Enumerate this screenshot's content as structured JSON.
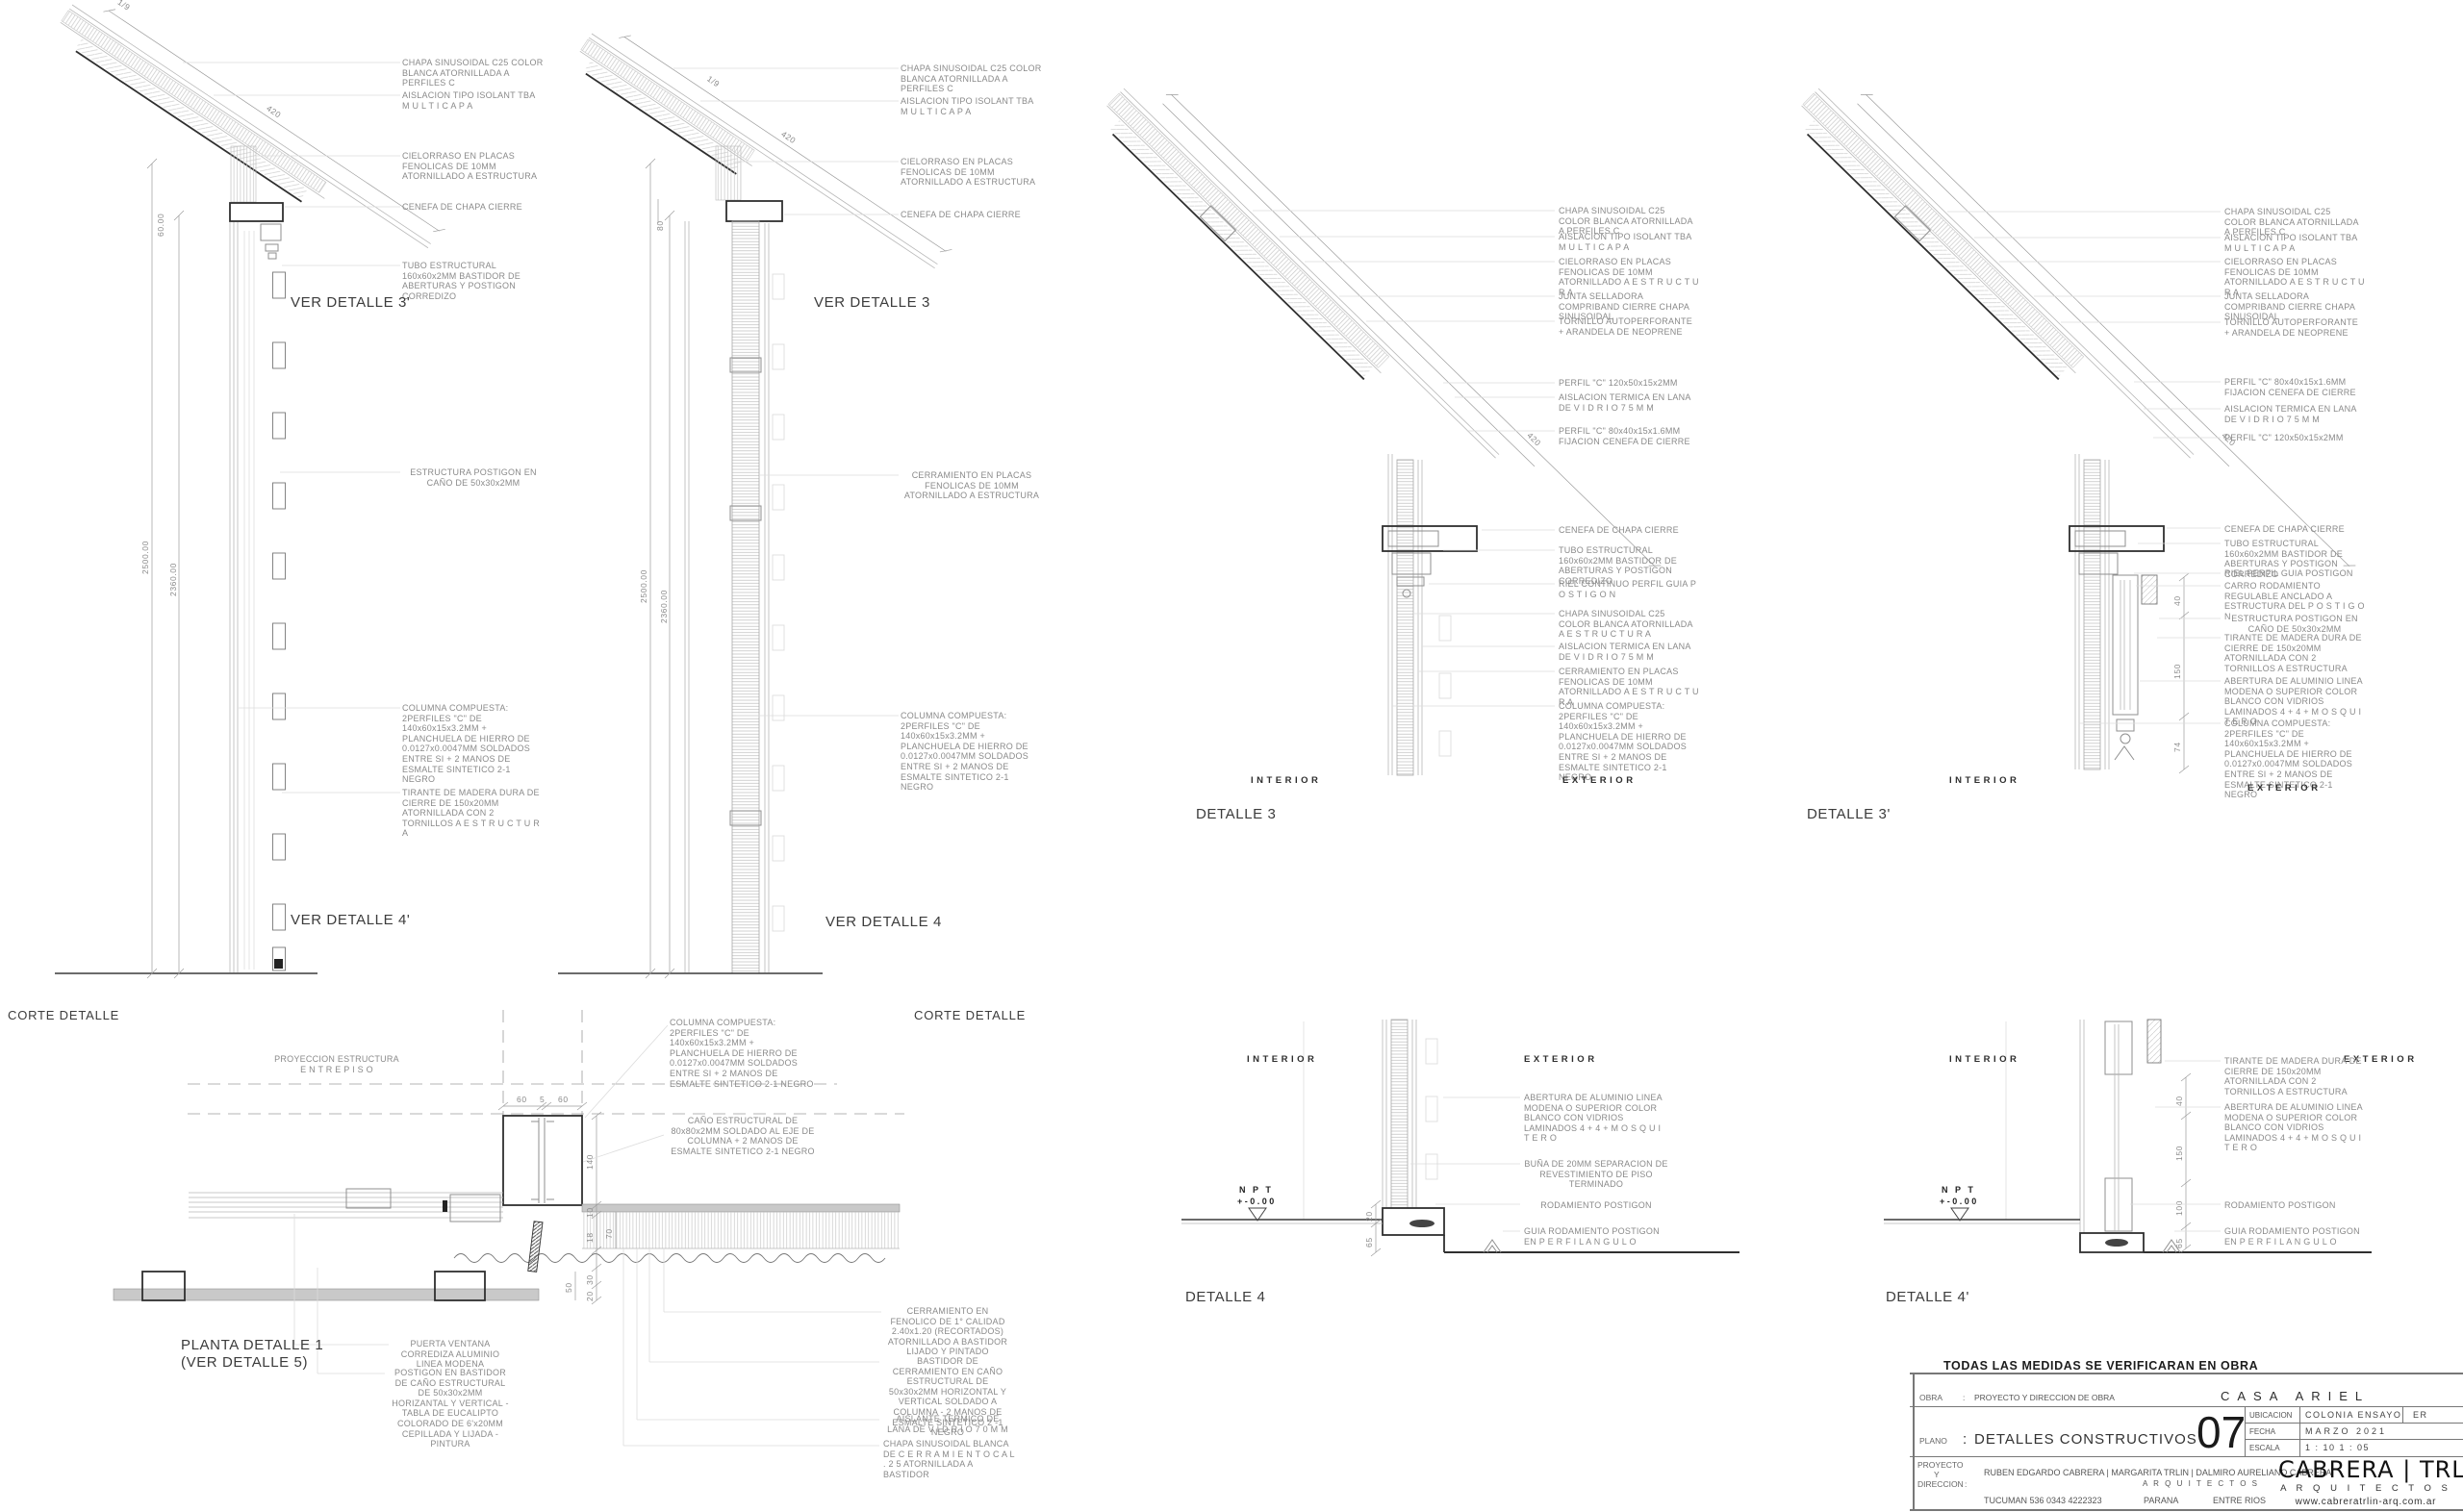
{
  "corte1": {
    "label": "CORTE DETALLE",
    "ver_top": "VER DETALLE 3'",
    "ver_bottom": "VER DETALLE 4'",
    "ann_chapa": "CHAPA SINUSOIDAL C25 COLOR BLANCA ATORNILLADA A PERFILES C",
    "ann_aislacion": "AISLACION TIPO ISOLANT TBA M U L T I C A P A",
    "ann_cielorraso": "CIELORRASO EN PLACAS FENOLICAS DE 10MM ATORNILLADO A ESTRUCTURA",
    "ann_cenefa": "CENEFA DE CHAPA  CIERRE",
    "ann_tubo": "TUBO ESTRUCTURAL 160x60x2MM BASTIDOR DE ABERTURAS Y POSTIGON CORREDIZO",
    "ann_estructura": "ESTRUCTURA POSTIGON EN CAÑO DE 50x30x2MM",
    "ann_columna": "COLUMNA COMPUESTA: 2PERFILES \"C\" DE 140x60x15x3.2MM + PLANCHUELA DE HIERRO DE 0.0127x0.0047MM SOLDADOS ENTRE SI + 2 MANOS DE ESMALTE SINTETICO 2-1 NEGRO",
    "ann_tirante": "TIRANTE DE MADERA DURA DE CIERRE DE 150x20MM ATORNILLADA CON 2 TORNILLOS A E S T R U C T U R A",
    "dim_slope": "1/9",
    "dim_420": "420",
    "dim_60": "60.00",
    "dim_2500": "2500.00",
    "dim_2360": "2360.00"
  },
  "corte2": {
    "label": "CORTE DETALLE",
    "ver_top": "VER DETALLE 3",
    "ver_bottom": "VER DETALLE 4",
    "ann_chapa": "CHAPA SINUSOIDAL C25 COLOR BLANCA ATORNILLADA A PERFILES C",
    "ann_aislacion": "AISLACION TIPO ISOLANT TBA M U L T I C A P A",
    "ann_cielorraso": "CIELORRASO EN PLACAS FENOLICAS DE 10MM ATORNILLADO A ESTRUCTURA",
    "ann_cenefa": "CENEFA DE CHAPA  CIERRE",
    "ann_cerramiento": "CERRAMIENTO EN PLACAS FENOLICAS DE 10MM ATORNILLADO A ESTRUCTURA",
    "ann_columna": "COLUMNA COMPUESTA: 2PERFILES \"C\" DE 140x60x15x3.2MM + PLANCHUELA DE HIERRO DE 0.0127x0.0047MM SOLDADOS ENTRE SI + 2 MANOS DE ESMALTE SINTETICO 2-1 NEGRO",
    "dim_slope": "1/9",
    "dim_420": "420",
    "dim_80": "80",
    "dim_2500": "2500.00",
    "dim_2360": "2360.00"
  },
  "detalle3": {
    "label": "DETALLE 3",
    "interior": "INTERIOR",
    "exterior": "EXTERIOR",
    "ann_chapa": "CHAPA SINUSOIDAL C25 COLOR BLANCA ATORNILLADA A PERFILES C",
    "ann_aislacion": "AISLACION TIPO ISOLANT TBA M U L T I C A P A",
    "ann_cielorraso": "CIELORRASO EN PLACAS FENOLICAS DE 10MM ATORNILLADO A E S T R U C T U R A",
    "ann_junta": "JUNTA SELLADORA COMPRIBAND CIERRE CHAPA SINUSOIDAL",
    "ann_tornillo": "TORNILLO AUTOPERFORANTE + ARANDELA DE NEOPRENE",
    "ann_perfil120": "PERFIL \"C\" 120x50x15x2MM",
    "ann_lana1": "AISLACION TERMICA EN LANA DE V I D R I O   7 5 M M",
    "ann_perfil80": "PERFIL \"C\" 80x40x15x1.6MM FIJACION CENEFA DE CIERRE",
    "ann_cenefa": "CENEFA DE CHAPA  CIERRE",
    "ann_tubo": "TUBO ESTRUCTURAL 160x60x2MM BASTIDOR DE ABERTURAS Y POSTIGON CORREDIZO",
    "ann_riel": "RIEL CONTINUO PERFIL GUIA P O S T I G O N",
    "ann_chapa2": "CHAPA SINUSOIDAL C25 COLOR BLANCA ATORNILLADA A E S T R U C T U R A",
    "ann_lana2": "AISLACION TERMICA EN LANA DE V I D R I O   7 5 M M",
    "ann_cerramiento": "CERRAMIENTO EN PLACAS FENOLICAS DE 10MM ATORNILLADO A  E S T R U C T U R A",
    "ann_columna": "COLUMNA COMPUESTA: 2PERFILES \"C\" DE 140x60x15x3.2MM + PLANCHUELA DE HIERRO DE 0.0127x0.0047MM SOLDADOS ENTRE SI + 2 MANOS DE ESMALTE SINTETICO 2-1 NEGRO",
    "dim_420": "420"
  },
  "detalle3p": {
    "label": "DETALLE 3'",
    "interior": "INTERIOR",
    "exterior": "EXTERIOR",
    "ann_chapa": "CHAPA SINUSOIDAL C25 COLOR BLANCA ATORNILLADA A PERFILES C",
    "ann_aislacion": "AISLACION TIPO ISOLANT TBA M U L T I C A P A",
    "ann_cielorraso": "CIELORRASO EN PLACAS FENOLICAS DE 10MM ATORNILLADO A E S T R U C T U R A",
    "ann_junta": "JUNTA SELLADORA COMPRIBAND CIERRE CHAPA SINUSOIDAL",
    "ann_tornillo": "TORNILLO AUTOPERFORANTE + ARANDELA DE NEOPRENE",
    "ann_perfil80": "PERFIL \"C\" 80x40x15x1.6MM FIJACION CENEFA DE CIERRE",
    "ann_lana": "AISLACION TERMICA EN LANA DE V I D R I O   7 5 M M",
    "ann_perfil120": "PERFIL \"C\" 120x50x15x2MM",
    "ann_cenefa": "CENEFA DE CHAPA  CIERRE",
    "ann_tubo": "TUBO ESTRUCTURAL 160x60x2MM BASTIDOR DE ABERTURAS Y POSTIGON CORREDIZO",
    "ann_riel": "RIEL PERFIL GUIA POSTIGON",
    "ann_carro": "CARRO RODAMIENTO REGULABLE ANCLADO A ESTRUCTURA DEL P O S T I G O N",
    "ann_estructura": "ESTRUCTURA POSTIGON EN CAÑO DE 50x30x2MM",
    "ann_tirante": "TIRANTE DE MADERA DURA DE CIERRE DE 150x20MM ATORNILLADA CON 2 TORNILLOS A ESTRUCTURA",
    "ann_abertura": "ABERTURA DE ALUMINIO  LINEA MODENA O SUPERIOR COLOR BLANCO CON VIDRIOS LAMINADOS 4 + 4  +  M O S Q U I T E R O",
    "ann_columna": "COLUMNA COMPUESTA: 2PERFILES \"C\" DE 140x60x15x3.2MM + PLANCHUELA DE HIERRO DE 0.0127x0.0047MM SOLDADOS ENTRE SI + 2 MANOS DE ESMALTE SINTETICO 2-1 NEGRO",
    "dim_420": "420",
    "dim_40": "40",
    "dim_150": "150",
    "dim_74": "74"
  },
  "detalle4": {
    "label": "DETALLE 4",
    "interior": "INTERIOR",
    "exterior": "EXTERIOR",
    "npt": "N P T",
    "npt_level": "+-0.00",
    "ann_abertura": "ABERTURA DE ALUMINIO  LINEA MODENA O SUPERIOR COLOR BLANCO CON VIDRIOS LAMINADOS 4 + 4  +  M O S Q U I T E R O",
    "ann_buna": "BUÑA DE 20MM SEPARACION DE REVESTIMIENTO DE PISO TERMINADO",
    "ann_rodamiento": "RODAMIENTO POSTIGON",
    "ann_guia": "GUIA RODAMIENTO POSTIGON EN P E R F I L   A N G U L O",
    "dim_20": "20",
    "dim_65": "65"
  },
  "detalle4p": {
    "label": "DETALLE 4'",
    "interior": "INTERIOR",
    "exterior": "EXTERIOR",
    "npt": "N P T",
    "npt_level": "+-0.00",
    "ann_tirante": "TIRANTE DE MADERA DURA DE CIERRE DE 150x20MM ATORNILLADA CON 2 TORNILLOS A ESTRUCTURA",
    "ann_abertura": "ABERTURA DE ALUMINIO  LINEA MODENA O SUPERIOR COLOR BLANCO CON VIDRIOS LAMINADOS 4 + 4  +  M O S Q U I T E R O",
    "ann_rodamiento": "RODAMIENTO POSTIGON",
    "ann_guia": "GUIA RODAMIENTO POSTIGON EN P E R F I L   A N G U L O",
    "dim_40": "40",
    "dim_150": "150",
    "dim_100": "100",
    "dim_65": "65"
  },
  "planta": {
    "label_line1": "PLANTA DETALLE 1",
    "label_line2": "(VER DETALLE 5)",
    "ann_proyeccion": "PROYECCION ESTRUCTURA E N T R E P I S O",
    "ann_columna": "COLUMNA COMPUESTA: 2PERFILES \"C\" DE 140x60x15x3.2MM + PLANCHUELA DE HIERRO DE 0.0127x0.0047MM SOLDADOS ENTRE SI + 2 MANOS DE ESMALTE SINTETICO 2-1 NEGRO",
    "ann_cano": "CAÑO ESTRUCTURAL DE 80x80x2MM SOLDADO AL EJE DE COLUMNA + 2 MANOS DE ESMALTE SINTETICO 2-1 NEGRO",
    "ann_puerta": "PUERTA VENTANA CORREDIZA ALUMINIO LINEA MODENA",
    "ann_postigon": "POSTIGON EN BASTIDOR DE CAÑO ESTRUCTURAL DE 50x30x2MM HORIZANTAL Y VERTICAL - TABLA DE EUCALIPTO COLORADO DE 6'x20MM CEPILLADA Y LIJADA - PINTURA",
    "ann_cerramiento": "CERRAMIENTO EN FENOLICO DE 1° CALIDAD 2.40x1.20 (RECORTADOS) ATORNILLADO A BASTIDOR LIJADO Y PINTADO",
    "ann_bastidor": "BASTIDOR DE CERRAMIENTO EN CAÑO ESTRUCTURAL DE 50x30x2MM HORIZONTAL Y VERTICAL SOLDADO A COLUMNA - 2 MANOS DE ESMALTE SINTETICO 2 -1 NEGRO",
    "ann_aislante": "AISLANTE TERMICO DE LANA DE V I D R I O   7 0 M M",
    "ann_chapa_blanca": "CHAPA  SINUSOIDAL BLANCA DE C E R R A M I E N T O  C A L .  2 5 ATORNILLADA A BASTIDOR",
    "dim_60a": "60",
    "dim_5": "5",
    "dim_60b": "60",
    "dim_140": "140",
    "dim_10": "10",
    "dim_70": "70",
    "dim_18": "18",
    "dim_50": "50",
    "dim_30": "30",
    "dim_20": "20"
  },
  "titleblock": {
    "note": "TODAS LAS MEDIDAS SE VERIFICARAN EN OBRA",
    "sep": ":",
    "obra_label": "OBRA",
    "obra_value": "PROYECTO Y DIRECCION DE OBRA",
    "project_name": "CASA ARIEL",
    "plano_label": "PLANO",
    "plano_value": "DETALLES CONSTRUCTIVOS",
    "sheet_number": "07",
    "ubicacion_label": "UBICACION",
    "ubicacion_value": "COLONIA ENSAYO",
    "ubicacion_prov": "ER",
    "fecha_label": "FECHA",
    "fecha_value": "MARZO 2021",
    "escala_label": "ESCALA",
    "escala_value": "1 : 10   1 : 05",
    "proyecto_label_1": "PROYECTO",
    "proyecto_label_2": "Y",
    "proyecto_label_3": "DIRECCION",
    "architects": "RUBEN EDGARDO CABRERA | MARGARITA TRLIN | DALMIRO AURELIANO CABRERA",
    "architects_suffix": "A R Q U I T E C T O S",
    "address": "TUCUMAN 536  0343 4222323",
    "city": "PARANA",
    "province": "ENTRE RIOS",
    "studio_name": "CABRERA | TRLIN",
    "studio_sub": "A R Q U I T E C T O S",
    "studio_web": "www.cabreratrlin-arq.com.ar"
  }
}
